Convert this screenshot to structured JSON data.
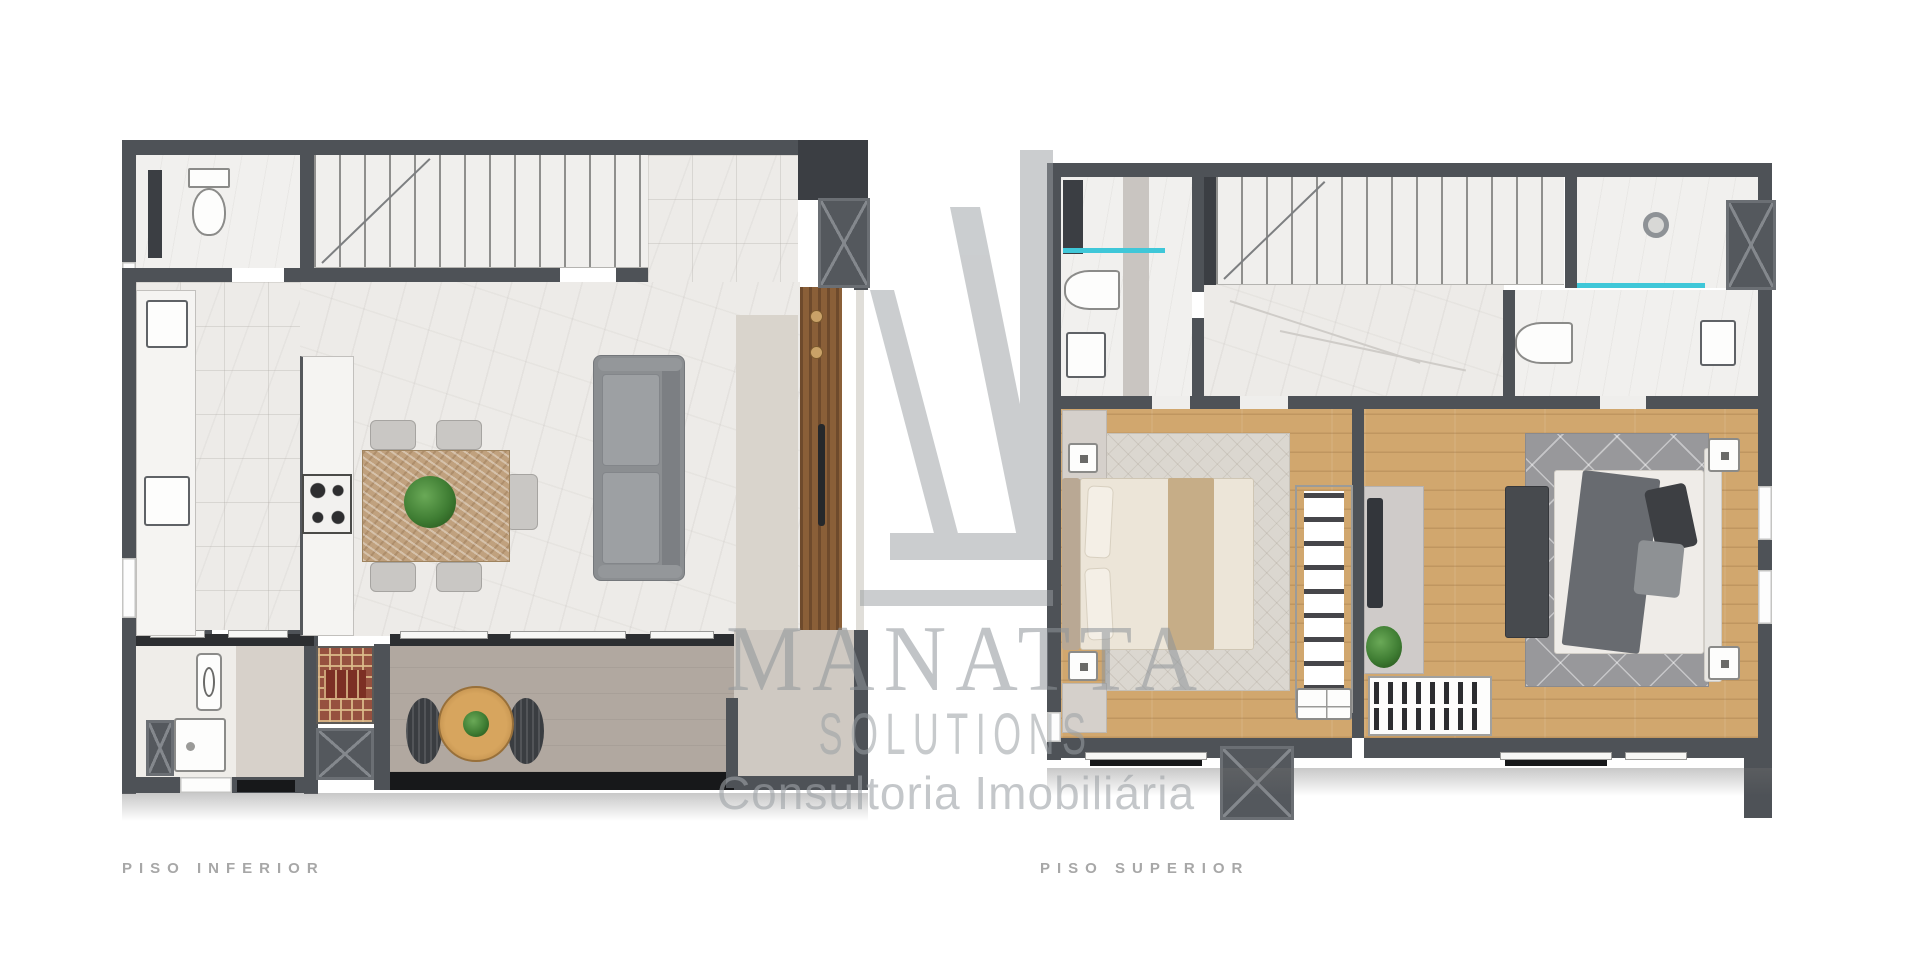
{
  "page": {
    "background_color": "#ffffff",
    "type": "real-estate floor plan render"
  },
  "watermark": {
    "logo": "manatta-monogram",
    "brand": "MANATTA",
    "brand_line2": "SOLUTIONS",
    "tagline": "Consultoria Imobiliária",
    "color": "#9aa0a4"
  },
  "floorplans": [
    {
      "label": "PISO INFERIOR"
    },
    {
      "label": "PISO SUPERIOR"
    }
  ],
  "colors": {
    "wall": "#4e5257",
    "marble_floor": "#edebe8",
    "wood_floor": "#d1a76e",
    "balcony_floor": "#b1a8a0",
    "granite_border": "#17181a",
    "glass_accent": "#3fc7d8",
    "plant_green": "#3f7d33",
    "sofa_gray": "#8b8e91",
    "brick_grill": "#96503f",
    "label_text": "#a7a7a7"
  }
}
